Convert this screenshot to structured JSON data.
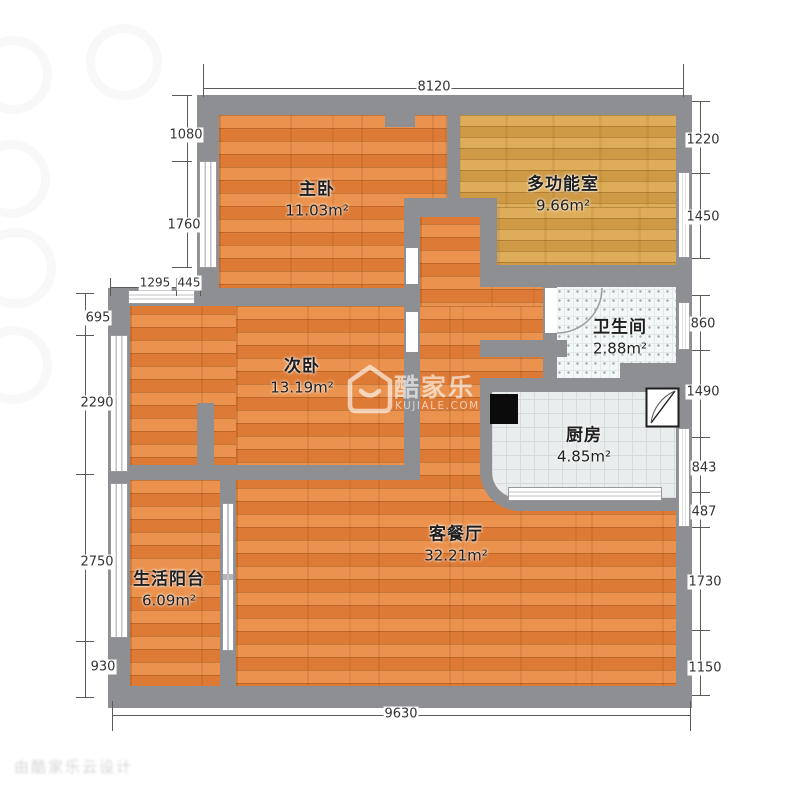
{
  "plan": {
    "type": "apartment-floor-plan",
    "rooms": [
      {
        "id": "master-bedroom",
        "name": "主卧",
        "area": "11.03",
        "unit": "m²"
      },
      {
        "id": "multi-function-room",
        "name": "多功能室",
        "area": "9.66",
        "unit": "m²"
      },
      {
        "id": "second-bedroom",
        "name": "次卧",
        "area": "13.19",
        "unit": "m²"
      },
      {
        "id": "bathroom",
        "name": "卫生间",
        "area": "2.88",
        "unit": "m²"
      },
      {
        "id": "kitchen",
        "name": "厨房",
        "area": "4.85",
        "unit": "m²"
      },
      {
        "id": "living-dining",
        "name": "客餐厅",
        "area": "32.21",
        "unit": "m²"
      },
      {
        "id": "balcony",
        "name": "生活阳台",
        "area": "6.09",
        "unit": "m²"
      }
    ],
    "dims": {
      "top": "8120",
      "bottom": "9630",
      "left": [
        "1080",
        "1760",
        "1295",
        "445",
        "695",
        "2290",
        "2750",
        "930"
      ],
      "right": [
        "1220",
        "1450",
        "860",
        "1490",
        "843",
        "487",
        "1730",
        "1150"
      ]
    }
  },
  "watermark": {
    "brand": "酷家乐",
    "site": "KUJIALE.COM",
    "corner_text": "由酷家乐云设计"
  },
  "colors": {
    "wall": "#8d8f93",
    "wood_floor": "#e5833c",
    "multi_room_floor": "#d6a24c",
    "bath_tile": "#f4f7f7",
    "kitchen_tile": "#eaeded",
    "dim_text": "#333333"
  }
}
